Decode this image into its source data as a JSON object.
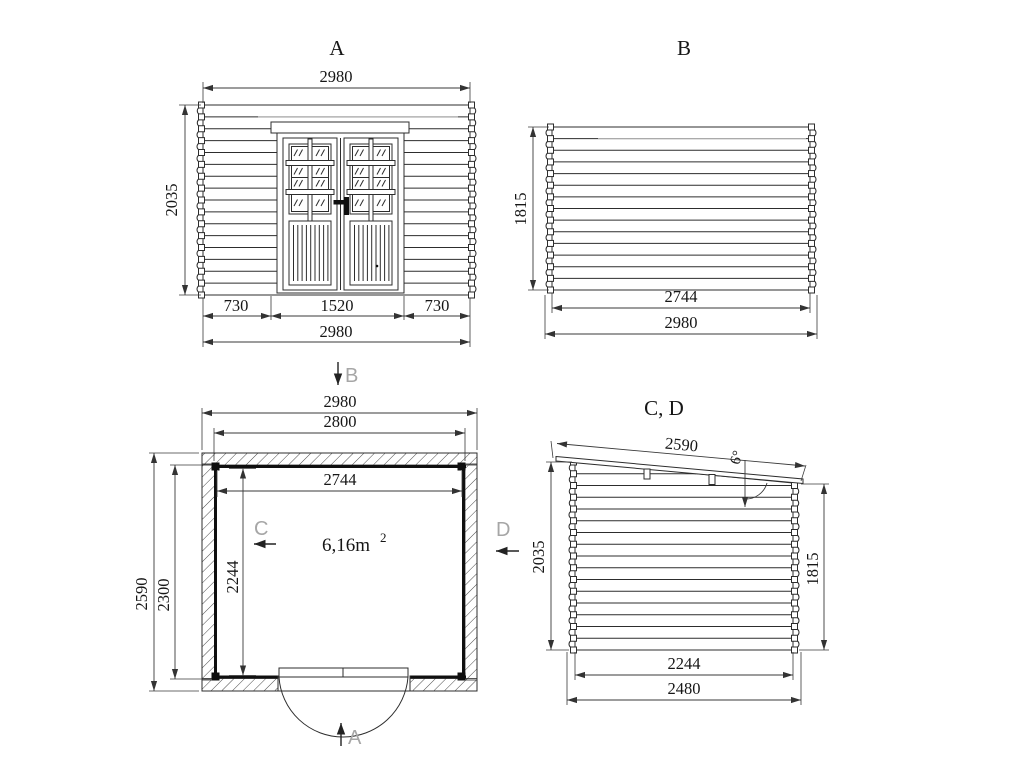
{
  "colors": {
    "line": "#2d2d2d",
    "section_letter": "#a6a6a6",
    "background": "#ffffff"
  },
  "views": {
    "front": {
      "label": "A",
      "dims": {
        "width_top": "2980",
        "height_left": "2035",
        "seg_left": "730",
        "seg_door": "1520",
        "seg_right": "730",
        "width_bottom": "2980"
      }
    },
    "back": {
      "label": "B",
      "dims": {
        "height_left": "1815",
        "inner_width": "2744",
        "outer_width": "2980"
      }
    },
    "plan": {
      "marker_top": "B",
      "marker_bottom": "A",
      "marker_left": "C",
      "marker_right": "D",
      "area": "6,16m",
      "area_sup": "2",
      "dims": {
        "outer_width": "2980",
        "wall_width": "2800",
        "inner_width": "2744",
        "inner_depth": "2244",
        "wall_depth": "2300",
        "roof_depth": "2590"
      }
    },
    "side": {
      "label": "C, D",
      "dims": {
        "roof_length": "2590",
        "roof_angle": "6°",
        "height_left": "2035",
        "height_right": "1815",
        "inner_width": "2244",
        "outer_width": "2480"
      }
    }
  }
}
